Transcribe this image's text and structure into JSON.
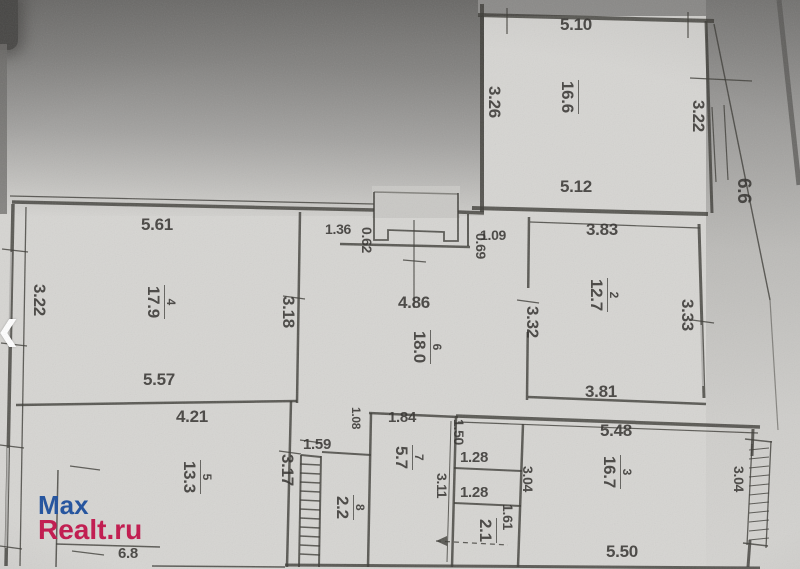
{
  "watermark": {
    "line1": "Max",
    "line2": "Realt.ru"
  },
  "nav": {
    "prev_arrow": "❮"
  },
  "rooms": [
    {
      "number": "",
      "area": "16.6"
    },
    {
      "number": "4",
      "area": "17.9"
    },
    {
      "number": "6",
      "area": "18.0"
    },
    {
      "number": "2",
      "area": "12.7"
    },
    {
      "number": "5",
      "area": "13.3"
    },
    {
      "number": "7",
      "area": "5.7"
    },
    {
      "number": "8",
      "area": "2.2"
    },
    {
      "number": "",
      "area": "2.1"
    },
    {
      "number": "3",
      "area": "16.7"
    }
  ],
  "balconies": {
    "right": "6.6",
    "bottom_left": "6.8"
  },
  "dims": {
    "d510": "5.10",
    "d561": "5.61",
    "d136": "1.36",
    "d109": "1.09",
    "d383": "3.83",
    "d512": "5.12",
    "d486": "4.86",
    "d557": "5.57",
    "d381": "3.81",
    "d421": "4.21",
    "d159": "1.59",
    "d184": "1.84",
    "d128a": "1.28",
    "d128b": "1.28",
    "d548": "5.48",
    "d550": "5.50",
    "v326": "3.26",
    "v322a": "3.22",
    "v062": "0.62",
    "v069": "0.69",
    "v322b": "3.22",
    "v318": "3.18",
    "v332": "3.32",
    "v333": "3.33",
    "v317": "3.17",
    "v150": "1.50",
    "v311": "3.11",
    "v161": "1.61",
    "v304a": "3.04",
    "v304b": "3.04",
    "v108": "1.08"
  }
}
